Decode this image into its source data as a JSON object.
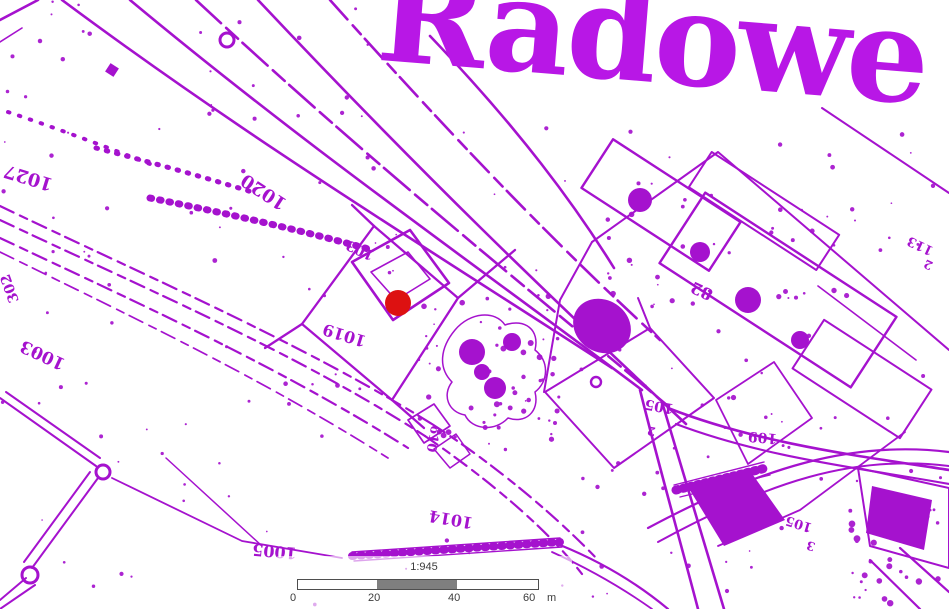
{
  "colors": {
    "map_ink": "#A512CE",
    "title_ink": "#B817E6",
    "marker_red": "#DD1111",
    "scale_gray": "#7F7F7F",
    "scale_border": "#4E4E4E",
    "scale_text": "#3C3C3C"
  },
  "map": {
    "title": "Radowe",
    "marker": {
      "x": 398,
      "y": 303,
      "radius": 13
    },
    "labels": [
      {
        "text": "1027",
        "x": 30,
        "y": 172,
        "rotate": 197,
        "size": 18
      },
      {
        "text": "1020",
        "x": 267,
        "y": 187,
        "rotate": 213,
        "size": 18
      },
      {
        "text": "103",
        "x": 362,
        "y": 246,
        "rotate": 205,
        "size": 14
      },
      {
        "text": "1019",
        "x": 346,
        "y": 330,
        "rotate": 197,
        "size": 16
      },
      {
        "text": "302",
        "x": 14,
        "y": 287,
        "rotate": 250,
        "size": 14
      },
      {
        "text": "1003",
        "x": 45,
        "y": 350,
        "rotate": 205,
        "size": 17
      },
      {
        "text": "610",
        "x": 429,
        "y": 438,
        "rotate": 100,
        "size": 13
      },
      {
        "text": "1014",
        "x": 452,
        "y": 514,
        "rotate": 190,
        "size": 16
      },
      {
        "text": "1005",
        "x": 275,
        "y": 546,
        "rotate": 185,
        "size": 16
      },
      {
        "text": "82",
        "x": 704,
        "y": 286,
        "rotate": 205,
        "size": 16
      },
      {
        "text": "105",
        "x": 660,
        "y": 402,
        "rotate": 190,
        "size": 14
      },
      {
        "text": "2",
        "x": 652,
        "y": 427,
        "rotate": 190,
        "size": 12
      },
      {
        "text": "109",
        "x": 763,
        "y": 433,
        "rotate": 185,
        "size": 14
      },
      {
        "text": "113",
        "x": 922,
        "y": 242,
        "rotate": 205,
        "size": 13
      },
      {
        "text": "2",
        "x": 930,
        "y": 261,
        "rotate": 205,
        "size": 12
      },
      {
        "text": "105",
        "x": 800,
        "y": 520,
        "rotate": 197,
        "size": 13
      },
      {
        "text": "3",
        "x": 812,
        "y": 542,
        "rotate": 197,
        "size": 12
      }
    ]
  },
  "scalebar": {
    "ratio_label": "1:945",
    "ticks": [
      "0",
      "20",
      "40",
      "60"
    ],
    "unit": "m"
  }
}
